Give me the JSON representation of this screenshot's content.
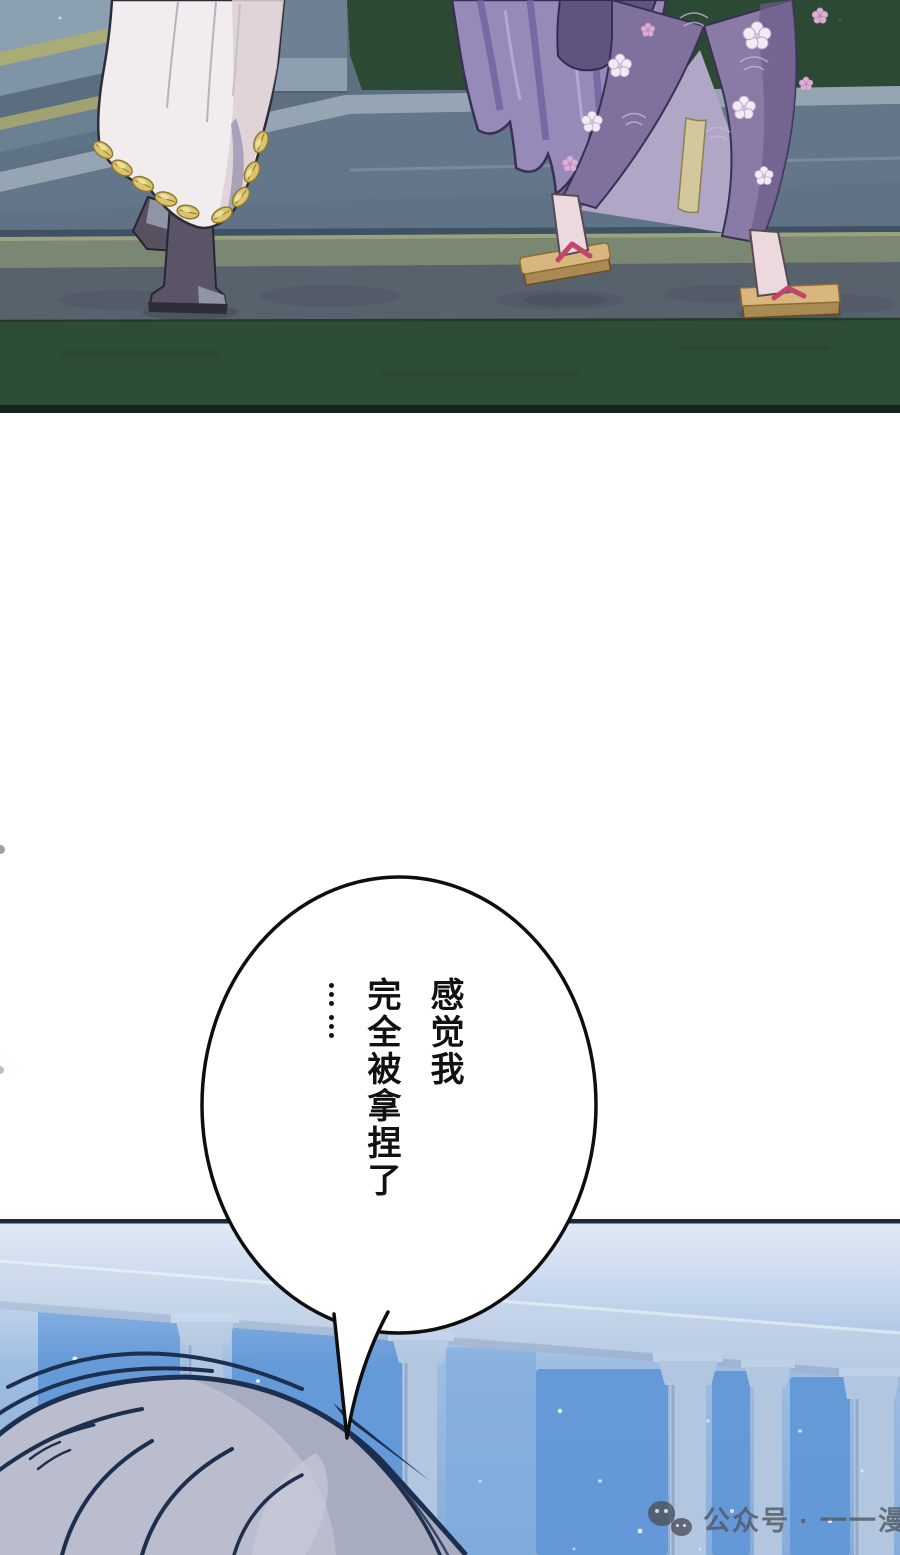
{
  "page": {
    "width": 900,
    "height": 1555,
    "background": "#ffffff"
  },
  "top_panel": {
    "colors": {
      "grass_top": "#2c4a33",
      "grass_bottom": "#2e4d35",
      "walkway_green": "#7a8772",
      "stone_path": "#58626d",
      "platform_face": "#64778a",
      "platform_highlight": "#95a5b3",
      "steps_tread": "#7f94a6",
      "moss_edge": "#a9ac77",
      "panel_border": "#15241c",
      "robe_white": "#f1edee",
      "robe_shadow_pink": "#decfd4",
      "robe_inner_gray": "#a8a3ba",
      "gold_trim": "#dcc46e",
      "boots": "#5a5466",
      "hair_purple": "#968ab8",
      "kimono_purple": "#8a7aa6",
      "kimono_dark": "#5f5380",
      "kimono_lining": "#b0a6c6",
      "sash_yellow": "#d3c79c",
      "sakura_white": "#f2eaf4",
      "sakura_pink": "#dbaed4",
      "skin": "#ecd9de",
      "geta_tan": "#d8b67e",
      "strap_red": "#c2456a"
    }
  },
  "speech_bubble": {
    "fill": "#ffffff",
    "stroke": "#0e0e0e",
    "text_color": "#111111",
    "lines": [
      "感觉我",
      "完全被拿捏了",
      "……"
    ],
    "full_text": "感觉我完全被拿捏了……"
  },
  "bottom_panel": {
    "colors": {
      "sky_deep": "#6197d8",
      "sky_haze": "#c3d4ea",
      "beam": "#b7cbe4",
      "column": "#b2c6e0",
      "hair_gray": "#b9bdcd",
      "hair_shadow": "#a6abbf",
      "line_dark": "#1c2f4e",
      "border": "#1d2a3d",
      "star": "#ffffff"
    },
    "watermark": {
      "icon": "wechat-icon",
      "text": "公众号 · 一一漫",
      "color": "#535861"
    }
  }
}
